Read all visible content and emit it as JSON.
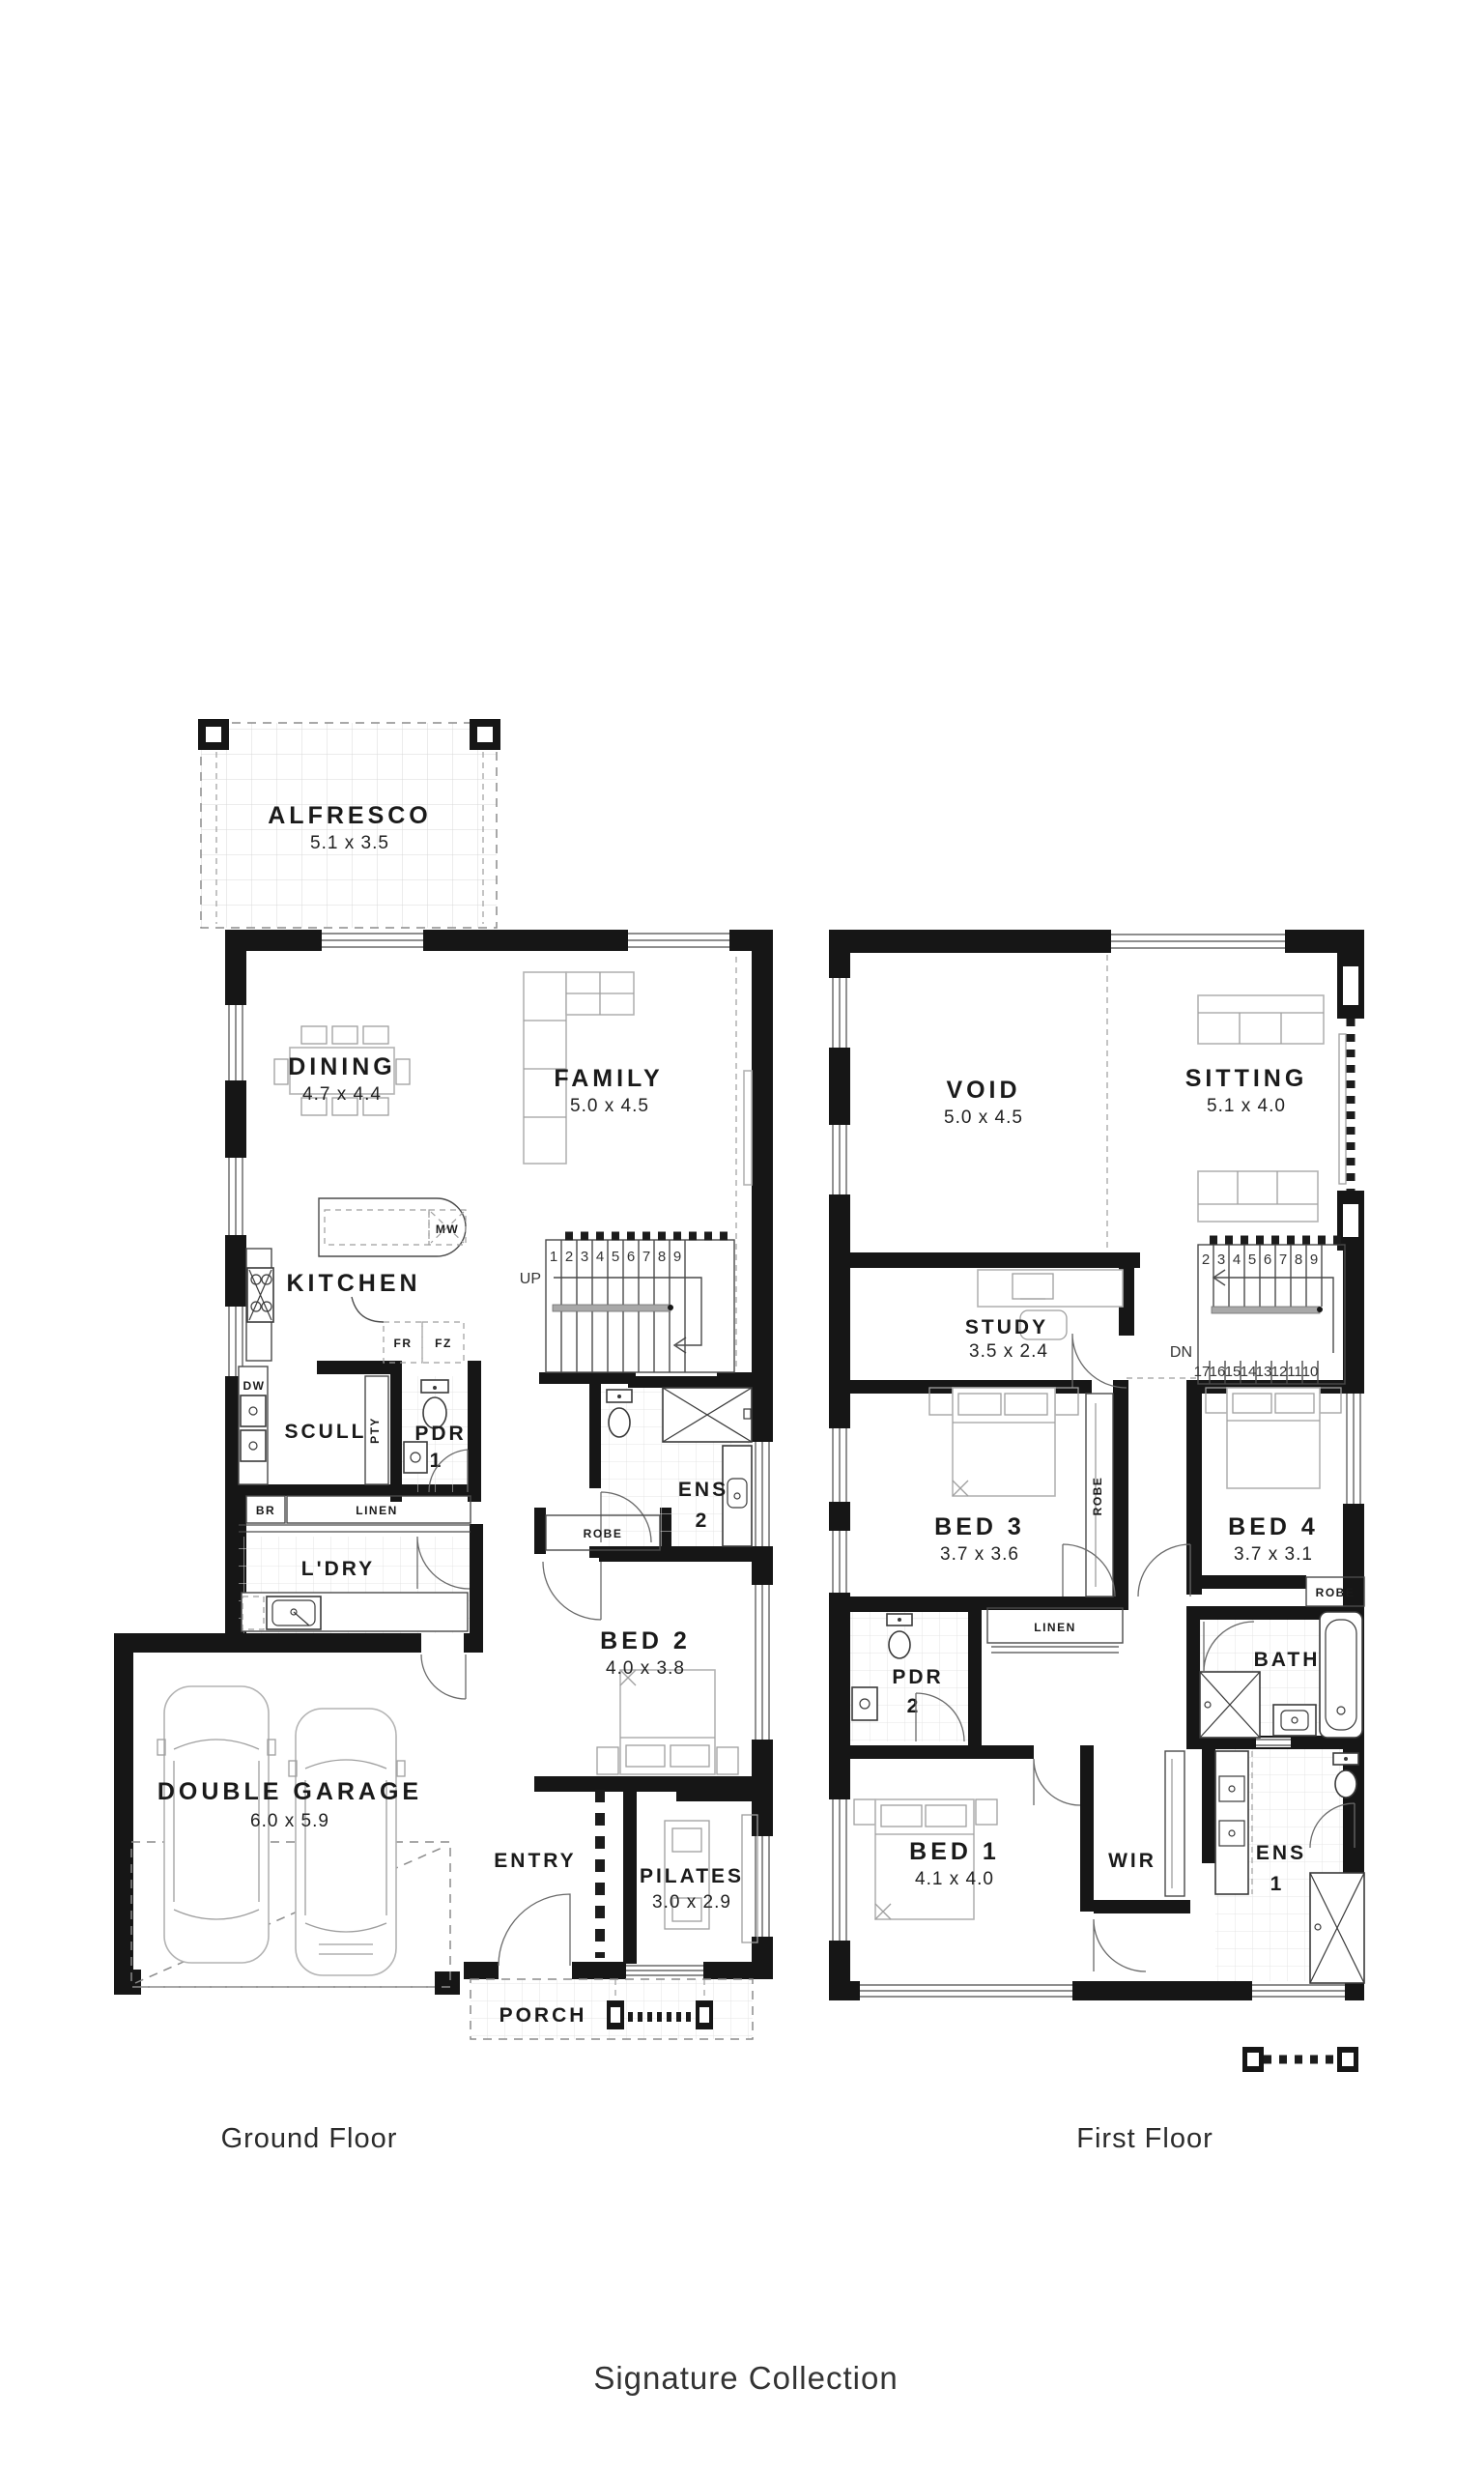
{
  "page": {
    "caption": "Signature Collection"
  },
  "floors": {
    "ground": {
      "caption": "Ground Floor",
      "rooms": {
        "alfresco": {
          "name": "ALFRESCO",
          "dims": "5.1 x 3.5"
        },
        "dining": {
          "name": "DINING",
          "dims": "4.7 x 4.4"
        },
        "family": {
          "name": "FAMILY",
          "dims": "5.0 x 4.5"
        },
        "kitchen": {
          "name": "KITCHEN"
        },
        "scullery": {
          "name": "SCULL"
        },
        "pdr1": {
          "name": "PDR",
          "number": "1"
        },
        "ens2": {
          "name": "ENS",
          "number": "2"
        },
        "laundry": {
          "name": "L'DRY"
        },
        "bed2": {
          "name": "BED 2",
          "dims": "4.0 x 3.8"
        },
        "garage": {
          "name": "DOUBLE GARAGE",
          "dims": "6.0 x 5.9"
        },
        "entry": {
          "name": "ENTRY"
        },
        "pilates": {
          "name": "PILATES",
          "dims": "3.0 x 2.9"
        },
        "porch": {
          "name": "PORCH"
        }
      },
      "fixtures": {
        "mw": "MW",
        "fr": "FR",
        "fz": "FZ",
        "dw": "DW",
        "pty": "PTY",
        "br": "BR",
        "linen": "LINEN",
        "robe": "ROBE"
      },
      "stairs": {
        "direction": "UP",
        "treads": [
          "1",
          "2",
          "3",
          "4",
          "5",
          "6",
          "7",
          "8",
          "9"
        ]
      }
    },
    "first": {
      "caption": "First Floor",
      "rooms": {
        "void": {
          "name": "VOID",
          "dims": "5.0 x 4.5"
        },
        "sitting": {
          "name": "SITTING",
          "dims": "5.1 x 4.0"
        },
        "study": {
          "name": "STUDY",
          "dims": "3.5 x 2.4"
        },
        "bed3": {
          "name": "BED 3",
          "dims": "3.7 x 3.6"
        },
        "bed4": {
          "name": "BED 4",
          "dims": "3.7 x 3.1"
        },
        "pdr2": {
          "name": "PDR",
          "number": "2"
        },
        "bath": {
          "name": "BATH"
        },
        "bed1": {
          "name": "BED 1",
          "dims": "4.1 x 4.0"
        },
        "wir": {
          "name": "WIR"
        },
        "ens1": {
          "name": "ENS",
          "number": "1"
        }
      },
      "fixtures": {
        "linen": "LINEN",
        "robe_bed3": "ROBE",
        "robe_bed4": "ROBE"
      },
      "stairs": {
        "direction": "DN",
        "treads_upper": [
          "2",
          "3",
          "4",
          "5",
          "6",
          "7",
          "8",
          "9"
        ],
        "treads_lower": [
          "17",
          "16",
          "15",
          "14",
          "13",
          "12",
          "11",
          "10"
        ]
      }
    }
  }
}
